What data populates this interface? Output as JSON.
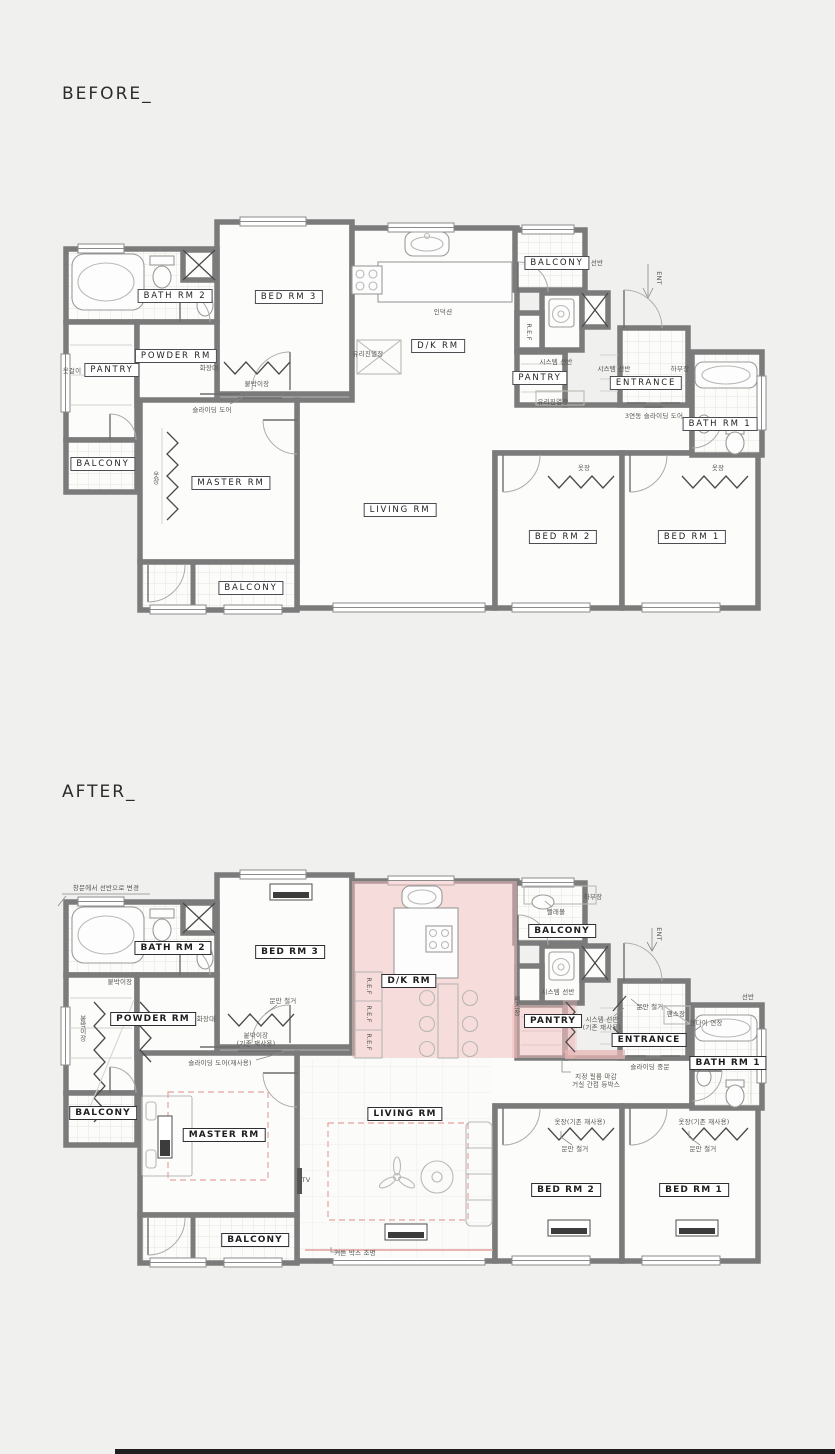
{
  "page": {
    "background": "#f0f0ee",
    "footer_bar_color": "#1f1f1f"
  },
  "colors": {
    "wall": "#7b7b7b",
    "floor": "#fcfcfa",
    "tile_line": "#e3e3e0",
    "highlight_pink": "#f0bcbc",
    "accent_pink": "#e49c9c"
  },
  "before": {
    "title": "BEFORE_",
    "rooms": [
      {
        "label": "BATH RM 2",
        "x": 175,
        "y": 296
      },
      {
        "label": "BED RM 3",
        "x": 289,
        "y": 297
      },
      {
        "label": "D/K RM",
        "x": 438,
        "y": 346
      },
      {
        "label": "BALCONY",
        "x": 557,
        "y": 263
      },
      {
        "label": "PANTRY",
        "x": 540,
        "y": 378
      },
      {
        "label": "ENTRANCE",
        "x": 646,
        "y": 383
      },
      {
        "label": "BATH RM 1",
        "x": 720,
        "y": 424
      },
      {
        "label": "PANTRY",
        "x": 112,
        "y": 370
      },
      {
        "label": "POWDER RM",
        "x": 176,
        "y": 356
      },
      {
        "label": "BALCONY",
        "x": 103,
        "y": 464
      },
      {
        "label": "MASTER RM",
        "x": 231,
        "y": 483
      },
      {
        "label": "LIVING RM",
        "x": 400,
        "y": 510
      },
      {
        "label": "BED RM 2",
        "x": 563,
        "y": 537
      },
      {
        "label": "BED RM 1",
        "x": 692,
        "y": 537
      },
      {
        "label": "BALCONY",
        "x": 251,
        "y": 588
      }
    ],
    "annotations": [
      {
        "text": "옷걸이",
        "x": 72,
        "y": 371
      },
      {
        "text": "화장대",
        "x": 209,
        "y": 368
      },
      {
        "text": "붙박이장",
        "x": 257,
        "y": 384
      },
      {
        "text": "슬라이딩 도어",
        "x": 212,
        "y": 410
      },
      {
        "text": "유리진열장",
        "x": 368,
        "y": 354
      },
      {
        "text": "인덕션",
        "x": 443,
        "y": 312
      },
      {
        "text": "R.E.F",
        "x": 529,
        "y": 332,
        "v": true
      },
      {
        "text": "선반",
        "x": 597,
        "y": 263
      },
      {
        "text": "시스템 선반",
        "x": 556,
        "y": 362
      },
      {
        "text": "시스템 선반",
        "x": 614,
        "y": 369
      },
      {
        "text": "유리진열장",
        "x": 553,
        "y": 402
      },
      {
        "text": "ENT",
        "x": 659,
        "y": 278,
        "v": true
      },
      {
        "text": "하부장",
        "x": 680,
        "y": 369
      },
      {
        "text": "3연동 슬라이딩 도어",
        "x": 654,
        "y": 416
      },
      {
        "text": "옷장",
        "x": 155,
        "y": 478,
        "v": true
      },
      {
        "text": "옷장",
        "x": 584,
        "y": 468
      },
      {
        "text": "옷장",
        "x": 718,
        "y": 468
      }
    ]
  },
  "after": {
    "title": "AFTER_",
    "rooms": [
      {
        "label": "BATH RM 2",
        "x": 173,
        "y": 948
      },
      {
        "label": "BED RM 3",
        "x": 290,
        "y": 952
      },
      {
        "label": "D/K RM",
        "x": 409,
        "y": 981
      },
      {
        "label": "BALCONY",
        "x": 562,
        "y": 931
      },
      {
        "label": "PANTRY",
        "x": 553,
        "y": 1021
      },
      {
        "label": "ENTRANCE",
        "x": 649,
        "y": 1040
      },
      {
        "label": "BATH RM 1",
        "x": 728,
        "y": 1063
      },
      {
        "label": "POWDER RM",
        "x": 153,
        "y": 1019
      },
      {
        "label": "BALCONY",
        "x": 103,
        "y": 1113
      },
      {
        "label": "MASTER RM",
        "x": 224,
        "y": 1135
      },
      {
        "label": "LIVING RM",
        "x": 405,
        "y": 1114
      },
      {
        "label": "BALCONY",
        "x": 255,
        "y": 1240
      },
      {
        "label": "BED RM 2",
        "x": 566,
        "y": 1190
      },
      {
        "label": "BED RM 1",
        "x": 694,
        "y": 1190
      }
    ],
    "annotations": [
      {
        "text": "창문에서 선반으로 변경",
        "x": 106,
        "y": 888
      },
      {
        "text": "붙박이장",
        "x": 120,
        "y": 982
      },
      {
        "text": "붙박이장",
        "x": 82,
        "y": 1028,
        "v": true
      },
      {
        "text": "화장대",
        "x": 206,
        "y": 1019
      },
      {
        "text": "문만 철거",
        "x": 283,
        "y": 1001
      },
      {
        "text": "붙박이장\n(기존 재사용)",
        "x": 256,
        "y": 1040
      },
      {
        "text": "슬라이딩 도어(재사용)",
        "x": 220,
        "y": 1063
      },
      {
        "text": "R.E.F",
        "x": 369,
        "y": 986,
        "v": true
      },
      {
        "text": "R.E.F",
        "x": 369,
        "y": 1014,
        "v": true
      },
      {
        "text": "R.E.F",
        "x": 369,
        "y": 1042,
        "v": true
      },
      {
        "text": "하부장",
        "x": 593,
        "y": 897
      },
      {
        "text": "빨래볼",
        "x": 556,
        "y": 912
      },
      {
        "text": "시스템 선반",
        "x": 558,
        "y": 992
      },
      {
        "text": "팬스장",
        "x": 516,
        "y": 1006,
        "v": true
      },
      {
        "text": "팬스장",
        "x": 676,
        "y": 1014
      },
      {
        "text": "문만 철거",
        "x": 650,
        "y": 1007
      },
      {
        "text": "시스템 선반\n(기존 재사용)",
        "x": 602,
        "y": 1024
      },
      {
        "text": "선반",
        "x": 748,
        "y": 997
      },
      {
        "text": "젠다이 연장",
        "x": 706,
        "y": 1023
      },
      {
        "text": "ENT",
        "x": 659,
        "y": 934,
        "v": true
      },
      {
        "text": "슬라이딩 중문",
        "x": 650,
        "y": 1067
      },
      {
        "text": "지정 필름 마감\n거실 간접 등박스",
        "x": 596,
        "y": 1081
      },
      {
        "text": "TV",
        "x": 306,
        "y": 1180
      },
      {
        "text": "커튼 박스 조명",
        "x": 355,
        "y": 1253
      },
      {
        "text": "옷장(기존 재사용)",
        "x": 580,
        "y": 1122
      },
      {
        "text": "옷장(기존 재사용)",
        "x": 704,
        "y": 1122
      },
      {
        "text": "문만 철거",
        "x": 575,
        "y": 1149
      },
      {
        "text": "문만 철거",
        "x": 703,
        "y": 1149
      }
    ]
  }
}
